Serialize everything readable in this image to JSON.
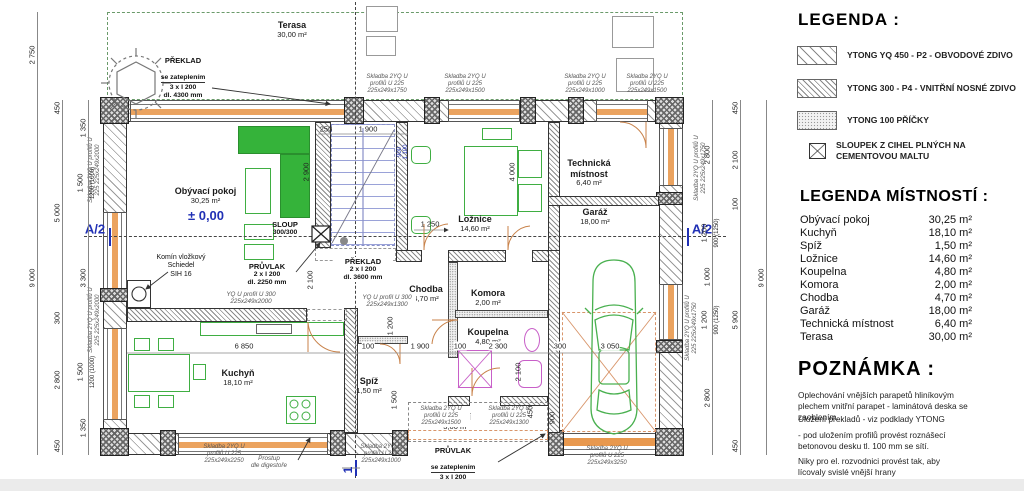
{
  "legend": {
    "title": "LEGENDA :",
    "items": [
      {
        "label": "YTONG YQ 450 - P2 - OBVODOVÉ ZDIVO"
      },
      {
        "label": "YTONG 300 - P4 - VNITŘNÍ NOSNÉ ZDIVO"
      },
      {
        "label": "YTONG 100 PŘÍČKY"
      },
      {
        "label": "SLOUPEK Z CIHEL PLNÝCH NA CEMENTOVOU MALTU"
      }
    ]
  },
  "rooms_legend": {
    "title": "LEGENDA  MÍSTNOSTÍ :",
    "rows": [
      {
        "name": "Obývací pokoj",
        "area": "30,25 m²"
      },
      {
        "name": "Kuchyň",
        "area": "18,10 m²"
      },
      {
        "name": "Spíž",
        "area": "1,50 m²"
      },
      {
        "name": "Ložnice",
        "area": "14,60 m²"
      },
      {
        "name": "Koupelna",
        "area": "4,80 m²"
      },
      {
        "name": "Komora",
        "area": "2,00 m²"
      },
      {
        "name": "Chodba",
        "area": "4,70 m²"
      },
      {
        "name": "Garáž",
        "area": "18,00 m²"
      },
      {
        "name": "Technická místnost",
        "area": "6,40 m²"
      },
      {
        "name": "Terasa",
        "area": "30,00 m²"
      }
    ]
  },
  "note": {
    "title": "POZNÁMKA :",
    "paragraphs": [
      "Oplechování vnějších parapetů hliníkovým plechem vnitřní parapet - laminátová deska se zaoblením.",
      "Uložení překladů - viz podklady YTONG",
      "- pod uložením profilů provést roznášecí betonovou desku tl. 100 mm se sítí.",
      "Niky pro el. rozvodnici provést tak, aby lícovaly svislé vnější hrany"
    ]
  },
  "plan": {
    "terasa": {
      "name": "Terasa",
      "area": "30,00 m²"
    },
    "rooms": [
      {
        "name": "Obývací pokoj",
        "area": "30,25 m²"
      },
      {
        "name": "Ložnice",
        "area": "14,60 m²"
      },
      {
        "name": "Technická místnost",
        "area": "6,40 m²"
      },
      {
        "name": "Garáž",
        "area": "18,00 m²"
      },
      {
        "name": "Chodba",
        "area": "4,70 m²"
      },
      {
        "name": "Komora",
        "area": "2,00 m²"
      },
      {
        "name": "Koupelna",
        "area": "4,80 m²"
      },
      {
        "name": "Spíž",
        "area": "1,50 m²"
      },
      {
        "name": "Kuchyň",
        "area": "18,10 m²"
      },
      {
        "name": "Závětří",
        "area": "3,00 m²"
      }
    ],
    "annotations": {
      "level": "± 0,00",
      "section_a2": "A/2",
      "section_1": "1",
      "preklad_top": {
        "l1": "PŘEKLAD",
        "l2": "se zateplením",
        "l3": "3 x I 200",
        "l4": "dl. 4300 mm"
      },
      "preklad_mid": {
        "l1": "PŘEKLAD",
        "l2": "2 x I 200",
        "l3": "dl. 3600 mm"
      },
      "pruvlak_mid": {
        "l1": "PRŮVLAK",
        "l2": "2 x I 200",
        "l3": "dl. 2250 mm"
      },
      "pruvlak_bot": {
        "l1": "PRŮVLAK",
        "l2": "se zateplením",
        "l3": "3 x I 200",
        "l4": "dl. 4300 mm"
      },
      "sloup": {
        "l1": "SLOUP",
        "l2": "300/300"
      },
      "komin": {
        "l1": "Komín vložkový",
        "l2": "Schiedel",
        "l3": "SIH 16"
      },
      "prostup": {
        "l1": "Prostup",
        "l2": "dle digestoře"
      },
      "yq300a": {
        "l1": "YQ U profil U 300",
        "l2": "225x249x2000"
      },
      "yq300b": {
        "l1": "YQ U profil U 300",
        "l2": "225x249x1300"
      }
    },
    "skladba": {
      "t1": "Skladba 2YQ U profilů U 225 225x249x1750",
      "t2": "Skladba 2YQ U profilů U 225 225x249x1500",
      "t3": "Skladba 2YQ U profilů U 225 225x249x1000",
      "t4": "Skladba 2YQ U profilů U 225 225x249x1500",
      "b1": "Skladba 2YQ U profilů U 225 225x249x2250",
      "b2": "Skladba 2YQ U profilů U 225 225x249x1000",
      "b3": "Skladba 2YQ U profilů U 225 225x249x1500",
      "b4": "Skladba 2YQ U profilů U 225 225x249x1300",
      "b5": "Skladba 2YQ U profilů U 225 225x249x3250",
      "lv1": "Skladba 2YQ U profilů U 225 225x249x2000",
      "lv2": "Skladba 2YQ U profilů U 225 225x249x2000",
      "rv1": "Skladba 2YQ U profilů U 225 225x249x1750",
      "rv2": "Skladba 2YQ U profilů U 225 225x249x1750"
    },
    "dims": {
      "l1": "2 750",
      "l2": "9 000",
      "m1": "450",
      "m2": "5 000",
      "m3": "300",
      "m4": "2 800",
      "m5": "450",
      "i1": "1 350",
      "i2": "1 500",
      "i2b": "1200 (1000)",
      "i3": "3 300",
      "i4": "1 500",
      "i4b": "1200 (1000)",
      "i5": "1 350",
      "r1": "2 800",
      "r2": "1 200",
      "r2b": "900 (1250)",
      "r3": "1 000",
      "r4": "1 200",
      "r4b": "900 (1250)",
      "r5": "2 800",
      "s1": "450",
      "s2": "2 100",
      "s3": "100",
      "s4": "5 900",
      "s5": "450",
      "o1": "9 000",
      "t1": "250",
      "t2": "1 900",
      "c1": "6 850",
      "c2": "100",
      "c3": "1 900",
      "c4": "100",
      "c5": "2 300",
      "c6": "300",
      "c7": "3 050",
      "v1": "2 900",
      "v2": "2 100",
      "v3": "4 000",
      "v4": "2 100",
      "v5": "1 200",
      "v6": "1 500",
      "v7": "450",
      "v8": "900",
      "v9": "1 250",
      "w1": "900",
      "w2": "1 100"
    }
  }
}
